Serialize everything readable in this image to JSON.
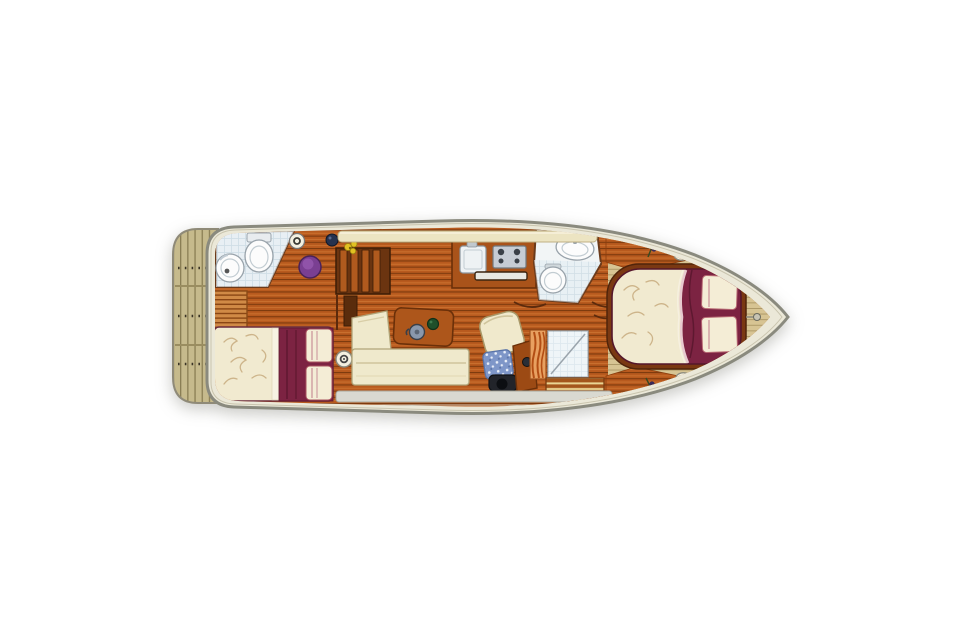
{
  "meta": {
    "page_background": "#ffffff",
    "image_kind": "boat-deck-floor-plan",
    "orientation": "bow-right-stern-left"
  },
  "plan": {
    "areas": [
      {
        "id": "swim-platform",
        "label": "swim platform with teak slats (stern)"
      },
      {
        "id": "aft-bathroom",
        "label": "aft bathroom: round washbasin, toilet, tiled floor"
      },
      {
        "id": "louver-locker",
        "label": "louvered locker"
      },
      {
        "id": "aft-cabin-bed",
        "label": "aft cabin double berth: cream floral duvet, burgundy runner, two pillows"
      },
      {
        "id": "companionway-steps",
        "label": "companionway steps"
      },
      {
        "id": "salon-sofa",
        "label": "L-shaped cream salon sofa"
      },
      {
        "id": "salon-table",
        "label": "wooden salon table with kettle and bottle"
      },
      {
        "id": "galley",
        "label": "galley counter with sink, stove and oven"
      },
      {
        "id": "day-head",
        "label": "second bathroom: oval washbasin and toilet"
      },
      {
        "id": "helm-seat",
        "label": "helm seat with blue cushion"
      },
      {
        "id": "shower-stall",
        "label": "shower stall with diagonal tray and slatted bench"
      },
      {
        "id": "bow-cabin-bed",
        "label": "bow cabin island berth: cream floral duvet, burgundy section, two pillows"
      },
      {
        "id": "bow-deck",
        "label": "foredeck planking with cleats and flower pots"
      }
    ]
  },
  "colors": {
    "page_bg": "#ffffff",
    "hull_fill": "#ebe8d8",
    "hull_stroke": "#8a8a7e",
    "floor_base": "#b85a1e",
    "floor_line": "#7d3a0e",
    "floor_light": "#cc7330",
    "bow_deck": "#d7c493",
    "bow_deck_line": "#ab9665",
    "platform_base": "#c6ba8c",
    "platform_line": "#8a7e54",
    "platform_dot": "#3a3426",
    "cabin_wood_dark": "#7a3812",
    "burgundy": "#7c2342",
    "burgundy_dark": "#5e1830",
    "duvet_cream": "#f1ead0",
    "floral_stroke": "#c9ae82",
    "pillow_cream": "#f4edd6",
    "pillow_stripe": "#c89098",
    "sofa_cream": "#efe9cc",
    "sofa_border": "#b0a478",
    "tile_base": "#e3edf3",
    "tile_line": "#bfd3de",
    "fixture_white": "#fcfcfc",
    "fixture_stroke": "#98a2aa",
    "stool_purple": "#7a3f92",
    "cushion_blue": "#7e96c8",
    "seat_base_dark": "#22242a",
    "table_wood": "#ad561b",
    "wood_edge": "#6b3009",
    "louver_base": "#d08a46",
    "louver_line": "#8a4614",
    "bench_wood": "#a4561c",
    "bench_slat": "#ead594",
    "radiator_base": "#e8a060",
    "radiator_line": "#b34e14",
    "strip_cream": "#ece4c2",
    "strip_border": "#c0b184",
    "walkway_grey": "#d9d9d1",
    "walkway_border": "#a6a69a",
    "cleat_white": "#f3f0e0",
    "flower_purple": "#5a4180",
    "flower_yellow": "#e2c122",
    "stove_grey": "#c6ccd4",
    "steel_dark": "#3a4048",
    "kettle_grey": "#8a98ac",
    "bottle_green": "#1f4f2a",
    "steps_dark": "#6b3410"
  }
}
